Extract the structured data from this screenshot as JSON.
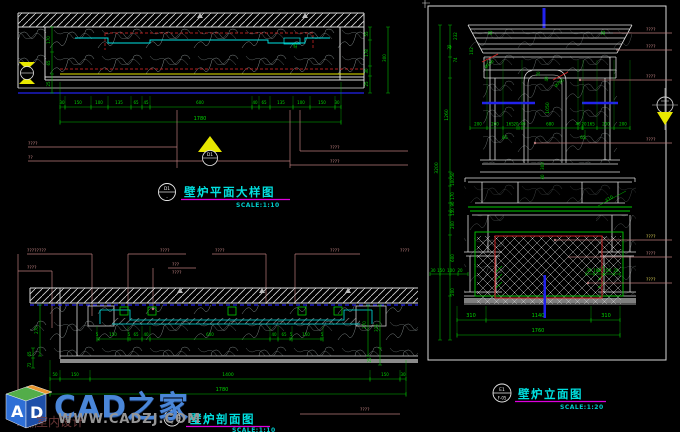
{
  "watermark": {
    "brand": "CAD之家",
    "site": "WWW.CADZJ.COM",
    "sub": "室内设计",
    "cube_a": "A",
    "cube_d": "D"
  },
  "plan": {
    "title": "壁炉平面大样图",
    "scale": "SCALE:1:10",
    "bubble": {
      "top": "D1",
      "bottom": "-"
    },
    "dims": {
      "chain": [
        "30",
        "150",
        "100",
        "135",
        "65",
        "45",
        "600",
        "40",
        "65",
        "135",
        "100",
        "150",
        "30"
      ],
      "total": "1780",
      "left": [
        "170",
        "65",
        "25"
      ],
      "right": [
        "55",
        "178",
        "300",
        "30",
        "25"
      ],
      "inner": "45",
      "leaders_left": [
        "????",
        "??"
      ],
      "leaders_right": [
        "????",
        "????"
      ]
    }
  },
  "section": {
    "title": "壁炉剖面图",
    "scale": "SCALE:1:10",
    "bubble": {
      "top": "S1",
      "bottom": "-"
    },
    "leaders": [
      "????????",
      "????",
      "????",
      "????",
      "????",
      "????"
    ],
    "leader_stack": [
      "???",
      "????"
    ],
    "dims": {
      "chain": [
        "5",
        "150",
        "5",
        "65",
        "40",
        "600",
        "40",
        "65",
        "5",
        "150",
        "5"
      ],
      "bottom": [
        "50",
        "150",
        "1400",
        "150",
        "30"
      ],
      "total": "1780",
      "left": [
        "270",
        "65",
        "72"
      ],
      "right": [
        "270",
        "325",
        "25"
      ],
      "floor_leader": "????",
      "corner_leader": "????"
    }
  },
  "elevation": {
    "title": "壁炉立面图",
    "scale": "SCALE:1:20",
    "bubble": {
      "top": "E1",
      "bottom": "F-05"
    },
    "right_leaders": [
      "????",
      "????",
      "????",
      "????",
      "????",
      "????",
      "????"
    ],
    "dims": {
      "total_height": "3200",
      "left_top": [
        "232",
        "22",
        "102",
        "74"
      ],
      "mid": "1260",
      "left_chain": [
        "50",
        "100",
        "170",
        "90",
        "150",
        "200",
        "600",
        "200"
      ],
      "top_chain_left": [
        "200",
        "200",
        "165",
        "20",
        "40"
      ],
      "top_center": "680",
      "top_chain_right": [
        "40",
        "20",
        "165",
        "200",
        "200"
      ],
      "cornice": [
        "35",
        "35"
      ],
      "arch": [
        "70",
        "40",
        "1050"
      ],
      "pilaster": [
        "65",
        "65"
      ],
      "hearth_v": [
        "300",
        "40"
      ],
      "diag": "310",
      "plinth_left": [
        "30",
        "150",
        "100",
        "20"
      ],
      "plinth_right": [
        "30",
        "100",
        "150",
        "20"
      ],
      "bottom": [
        "310",
        "1140",
        "310"
      ],
      "bottom_total": "1760",
      "radius_labels": [
        "Ø196",
        "Ø785"
      ]
    }
  }
}
